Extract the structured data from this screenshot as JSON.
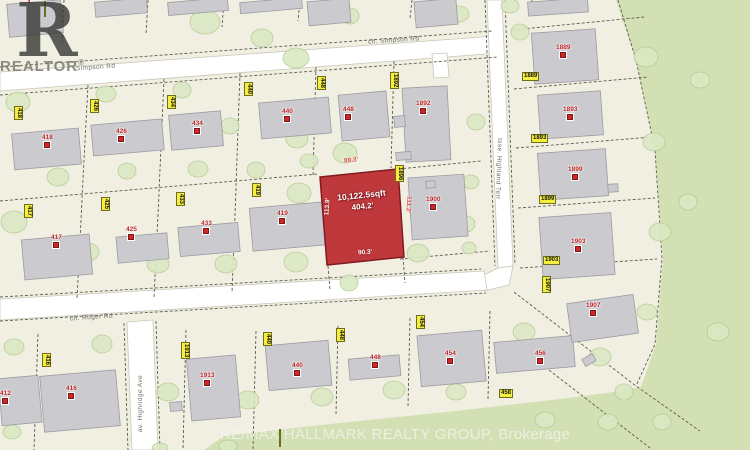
{
  "map": {
    "subject_lot": {
      "area": "10,122.5sqft",
      "frontage": "404.2'",
      "dim_top": "89.3'",
      "dim_left": "113.9'",
      "dim_right": "111.2'",
      "dim_bottom": "90.3'"
    },
    "streets": {
      "simpson_left": "Simpson Rd",
      "simpson": "ch. Simpson Rd",
      "roger": "ch. Roger Rd",
      "highland": "tsse. Highland Terr",
      "highridge": "av. Highridge Ave"
    },
    "address_tags": [
      "418",
      "426",
      "434",
      "440",
      "448",
      "1892",
      "1896",
      "419",
      "417",
      "425",
      "433",
      "1889",
      "1893",
      "1899",
      "1903",
      "1907",
      "416",
      "1913",
      "440",
      "448",
      "454",
      "458",
      "",
      ""
    ],
    "house_labels": [
      "418",
      "426",
      "434",
      "440",
      "448",
      "1892",
      "417",
      "425",
      "433",
      "419",
      "1900",
      "412",
      "416",
      "1913",
      "440",
      "448",
      "454",
      "456",
      "1907",
      "1889",
      "1893",
      "1899",
      "1903",
      "4"
    ]
  },
  "watermarks": {
    "realtor_letter": "R",
    "realtor_text": "REALTOR",
    "registered": "®",
    "brokerage": "RE/MAX HALLMARK REALTY GROUP, Brokerage"
  },
  "colors": {
    "base": "#f1efe2",
    "green_area": "#d2e0b4",
    "road": "#ffffff",
    "building_fill": "#cbcbcf",
    "subject_lot_fill": "#bf393c",
    "tag_bg": "#f6ee3e",
    "label_red": "#c22a2a"
  }
}
